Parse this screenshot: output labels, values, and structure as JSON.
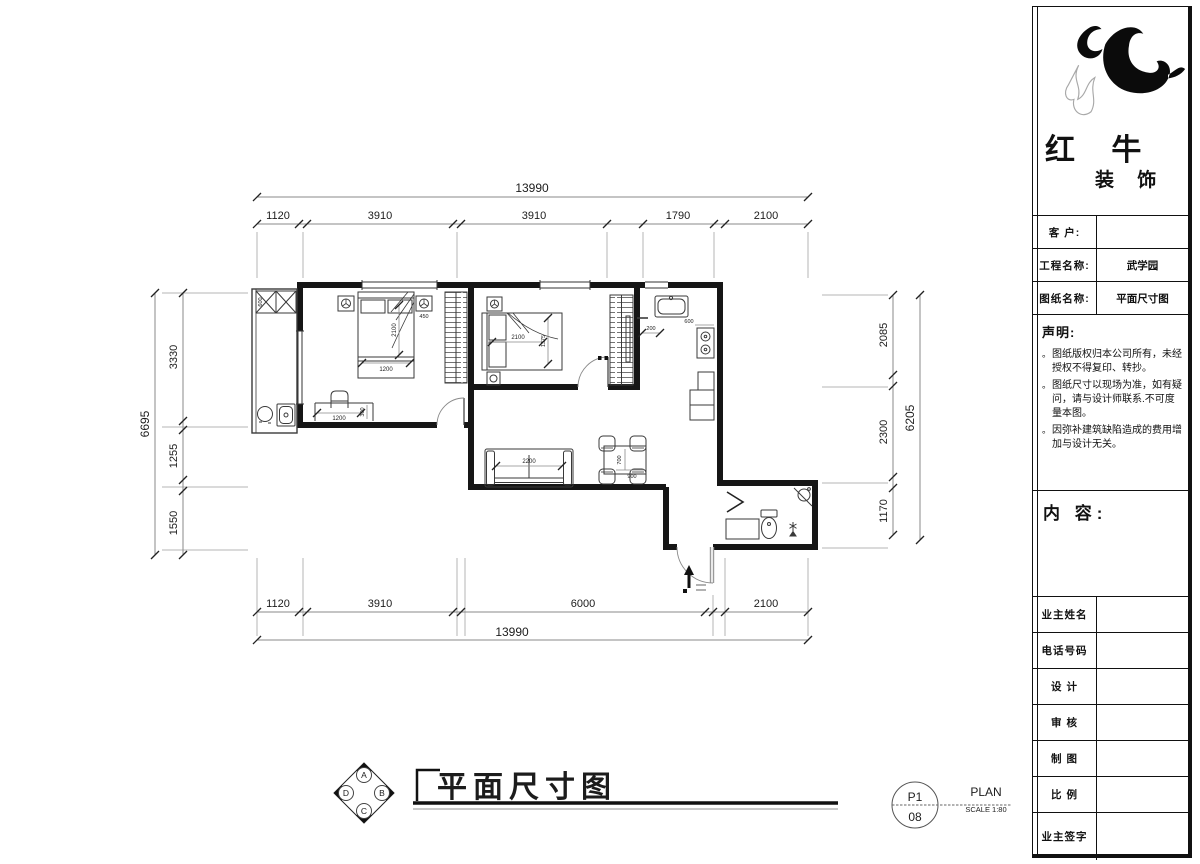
{
  "page": {
    "bg": "#ffffff",
    "wall_color": "#161616",
    "dim_color": "#8a8a8a",
    "text_color": "#1c1c1c"
  },
  "dims": {
    "top": {
      "total": "13990",
      "seg1": "1120",
      "seg2": "3910",
      "seg3": "3910",
      "seg4": "1790",
      "seg5": "2100"
    },
    "bottom": {
      "total": "13990",
      "seg1": "1120",
      "seg2": "3910",
      "seg3": "6000",
      "seg4": "2100"
    },
    "left": {
      "total": "6695",
      "seg1": "3330",
      "seg2": "1255",
      "seg3": "1550"
    },
    "right": {
      "total": "6205",
      "seg1": "2085",
      "seg2": "2300",
      "seg3": "1170"
    }
  },
  "plan_labels": {
    "bed1_len": "2100",
    "bed1_w": "1200",
    "nightstand": "450",
    "desk_w": "1200",
    "desk_d": "300",
    "bed2_len": "2100",
    "bed2_w": "1375",
    "sofa": "2200",
    "table_d": "700",
    "table_w": "900",
    "stove": "600",
    "kitchen_stub": "200",
    "balcony_cabinet": "600"
  },
  "footer": {
    "title": "平面尺寸图",
    "sheet_no_top": "P1",
    "sheet_no_bottom": "08",
    "plan_label": "PLAN",
    "scale_label": "SCALE 1:80",
    "compass": {
      "n": "A",
      "e": "B",
      "s": "C",
      "w": "D"
    }
  },
  "titleblock": {
    "brand_main": "红 牛",
    "brand_sub": "装 饰",
    "customer_label": "客 户:",
    "customer_value": "",
    "project_label": "工程名称:",
    "project_value": "武学园",
    "drawing_label": "图纸名称:",
    "drawing_value": "平面尺寸图",
    "statement_title": "声明:",
    "statement_bullet": "。",
    "statement_items": [
      "图纸版权归本公司所有，未经授权不得复印、转抄。",
      "图纸尺寸以现场为准，如有疑问，请与设计师联系.不可度量本图。",
      "因弥补建筑缺陷造成的费用增加与设计无关。"
    ],
    "content_label": "内 容:",
    "rows": [
      "业主姓名",
      "电话号码",
      "设 计",
      "审 核",
      "制 图",
      "比 例",
      "业主签字"
    ]
  }
}
